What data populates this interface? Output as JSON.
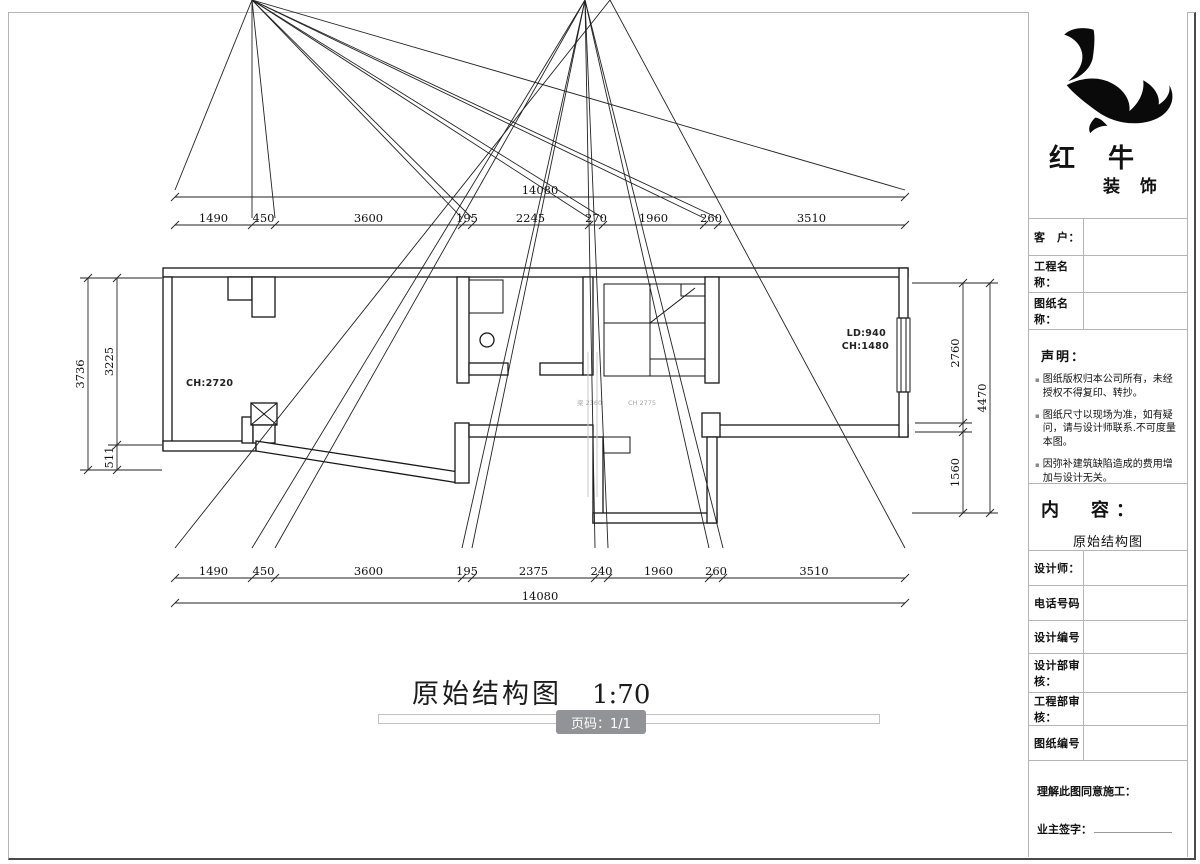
{
  "plan": {
    "room_labels": {
      "left_ch": "CH:2720",
      "right_ld": "LD:940",
      "right_ch": "CH:1480"
    },
    "beam_notes": {
      "note1": "梁 2360",
      "note2": "CH 2775"
    }
  },
  "dimensions": {
    "top": {
      "overall": "14080",
      "segments": [
        "1490",
        "450",
        "3600",
        "195",
        "2245",
        "270",
        "1960",
        "260",
        "3510"
      ]
    },
    "bottom": {
      "overall": "14080",
      "segments": [
        "1490",
        "450",
        "3600",
        "195",
        "2375",
        "240",
        "1960",
        "260",
        "3510"
      ]
    },
    "left": {
      "overall": "3736",
      "segments": [
        "3225",
        "511"
      ]
    },
    "right": {
      "overall": "4470",
      "segments": [
        "2760",
        "",
        "1560"
      ]
    }
  },
  "footer_title": {
    "title": "原始结构图",
    "scale": "1:70"
  },
  "page_badge": "页码：1/1",
  "titleblock": {
    "brand": {
      "name_top": "红 牛",
      "name_bottom": "装 饰"
    },
    "fields_top": [
      "客　户：",
      "工程名称：",
      "图纸名称："
    ],
    "statement": {
      "heading": "声明：",
      "items": [
        "图纸版权归本公司所有，未经授权不得复印、转抄。",
        "图纸尺寸以现场为准，如有疑问，请与设计师联系.不可度量本图。",
        "因弥补建筑缺陷造成的费用增加与设计无关。"
      ]
    },
    "content": {
      "heading": "内　容：",
      "value": "原始结构图"
    },
    "fields_mid": [
      "设计师：",
      "电话号码",
      "设计编号",
      "设计部审核：",
      "工程部审核：",
      "图纸编号"
    ],
    "footer": {
      "agree": "理解此图同意施工：",
      "sign": "业主签字："
    }
  }
}
